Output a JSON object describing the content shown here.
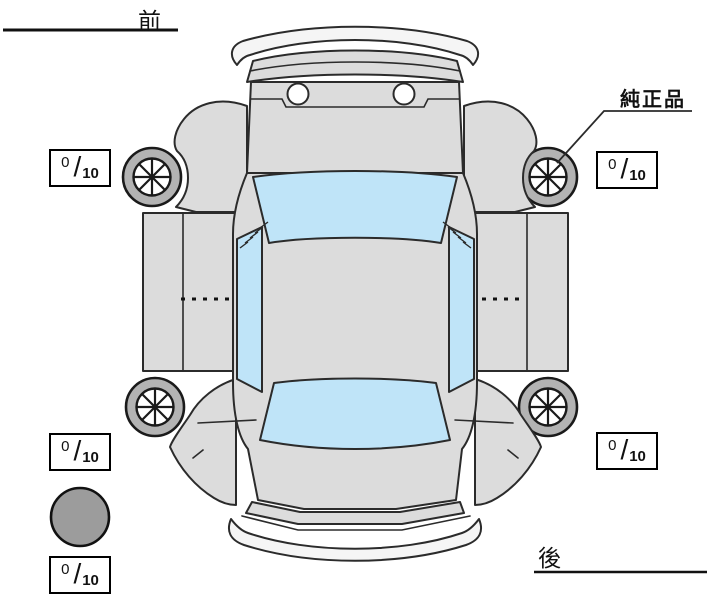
{
  "labels": {
    "front": "前",
    "rear": "後",
    "genuine_parts": "純正品"
  },
  "tread_fraction_slash": "/",
  "tread": {
    "front_left": {
      "value": "0",
      "max": "10"
    },
    "front_right": {
      "value": "0",
      "max": "10"
    },
    "rear_left": {
      "value": "0",
      "max": "10"
    },
    "rear_right": {
      "value": "0",
      "max": "10"
    },
    "spare": {
      "value": "0",
      "max": "10"
    }
  },
  "colors": {
    "body": "#dcdcdc",
    "glass": "#bfe4f8",
    "wheel_ring": "#b3b3b3",
    "spare_tire": "#9c9c9c",
    "bumper": "#f5f5f5",
    "headlight": "#ffffff"
  }
}
